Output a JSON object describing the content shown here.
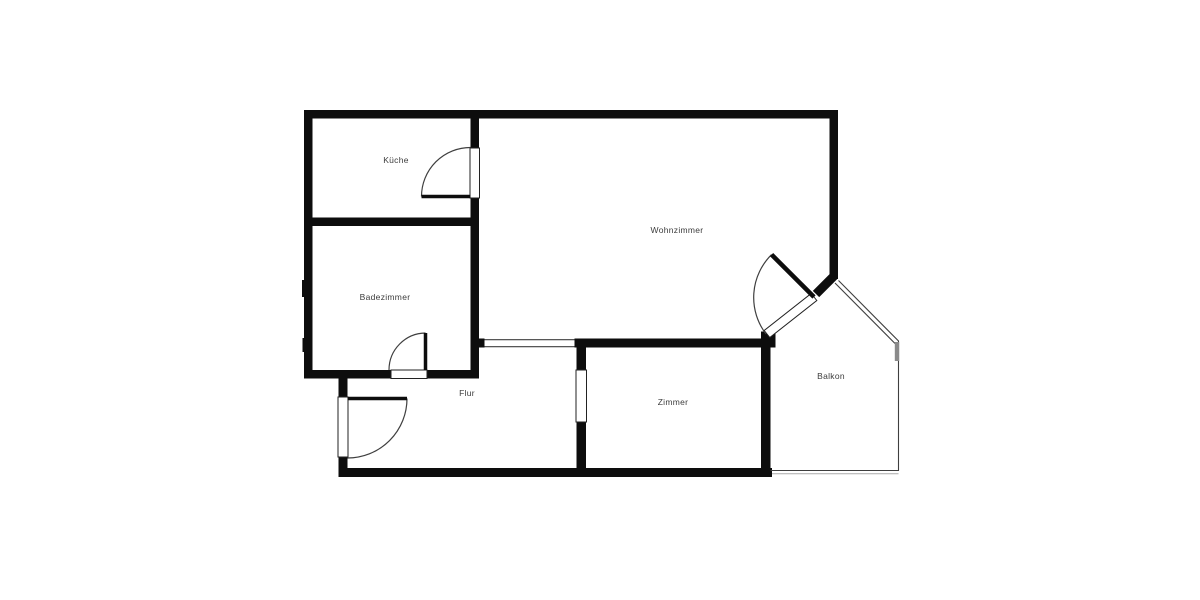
{
  "plan": {
    "type": "floor-plan",
    "rooms": [
      {
        "label": "Küche"
      },
      {
        "label": "Badezimmer"
      },
      {
        "label": "Wohnzimmer"
      },
      {
        "label": "Flur"
      },
      {
        "label": "Zimmer"
      },
      {
        "label": "Balkon"
      }
    ],
    "colors": {
      "background": "#ffffff",
      "walls": "#0d0d0d",
      "thin_lines": "#3f3f3f",
      "labels": "#3c3c3c",
      "balcony_post": "#8a8a8a"
    }
  }
}
